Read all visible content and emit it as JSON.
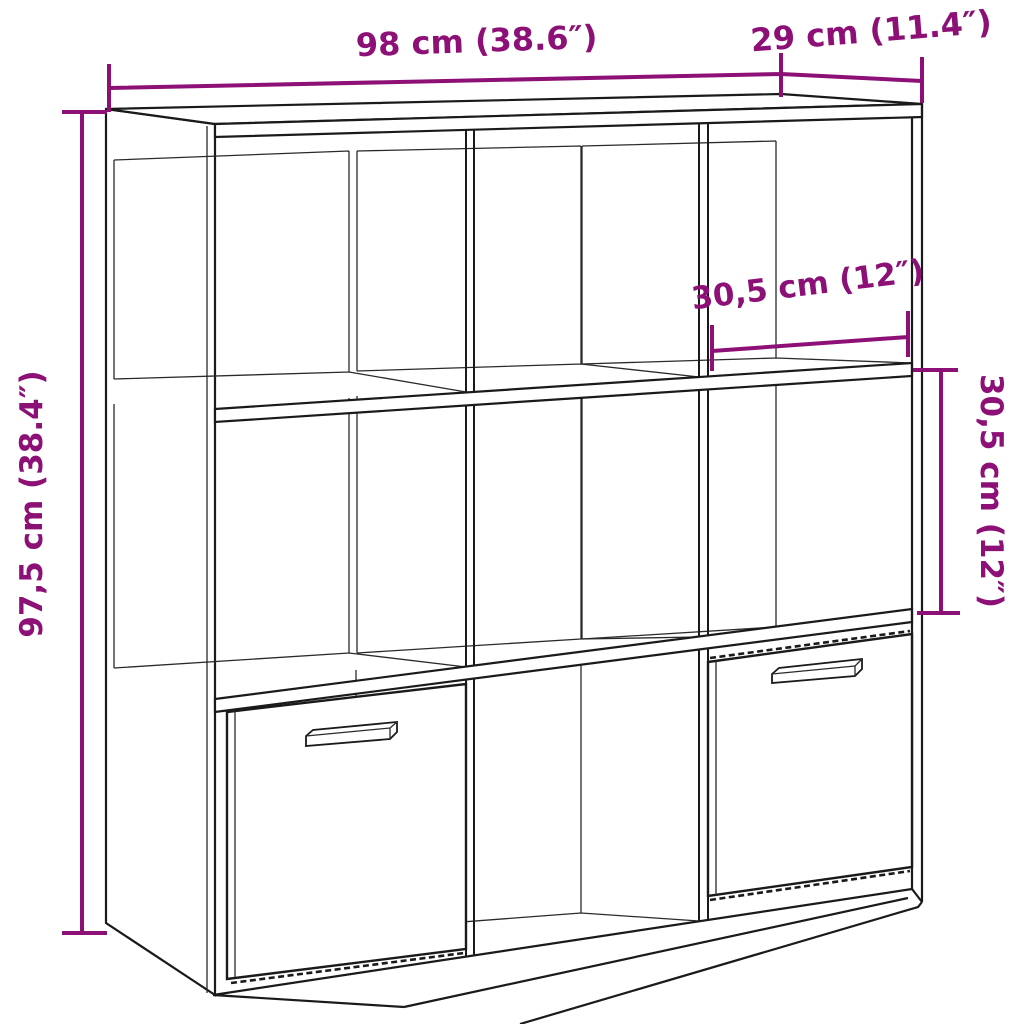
{
  "diagram": {
    "title": "Bookcase dimension diagram",
    "product_type": "Cube bookcase with 3x3 compartments and 2 drawers",
    "style": {
      "dimension_color": "#8C1076",
      "outline_color": "#1a1a1a",
      "background": "#ffffff"
    },
    "dimensions": {
      "overall_width": {
        "label": "98 cm (38.6″)",
        "cm": "98",
        "inches": "38.6"
      },
      "overall_depth": {
        "label": "29 cm (11.4″)",
        "cm": "29",
        "inches": "11.4"
      },
      "compartment_width": {
        "label": "30,5 cm (12″)",
        "cm": "30,5",
        "inches": "12"
      },
      "compartment_height": {
        "label": "30,5 cm (12″)",
        "cm": "30,5",
        "inches": "12"
      },
      "overall_height": {
        "label": "97,5 cm (38.4″)",
        "cm": "97,5",
        "inches": "38.4"
      }
    }
  }
}
